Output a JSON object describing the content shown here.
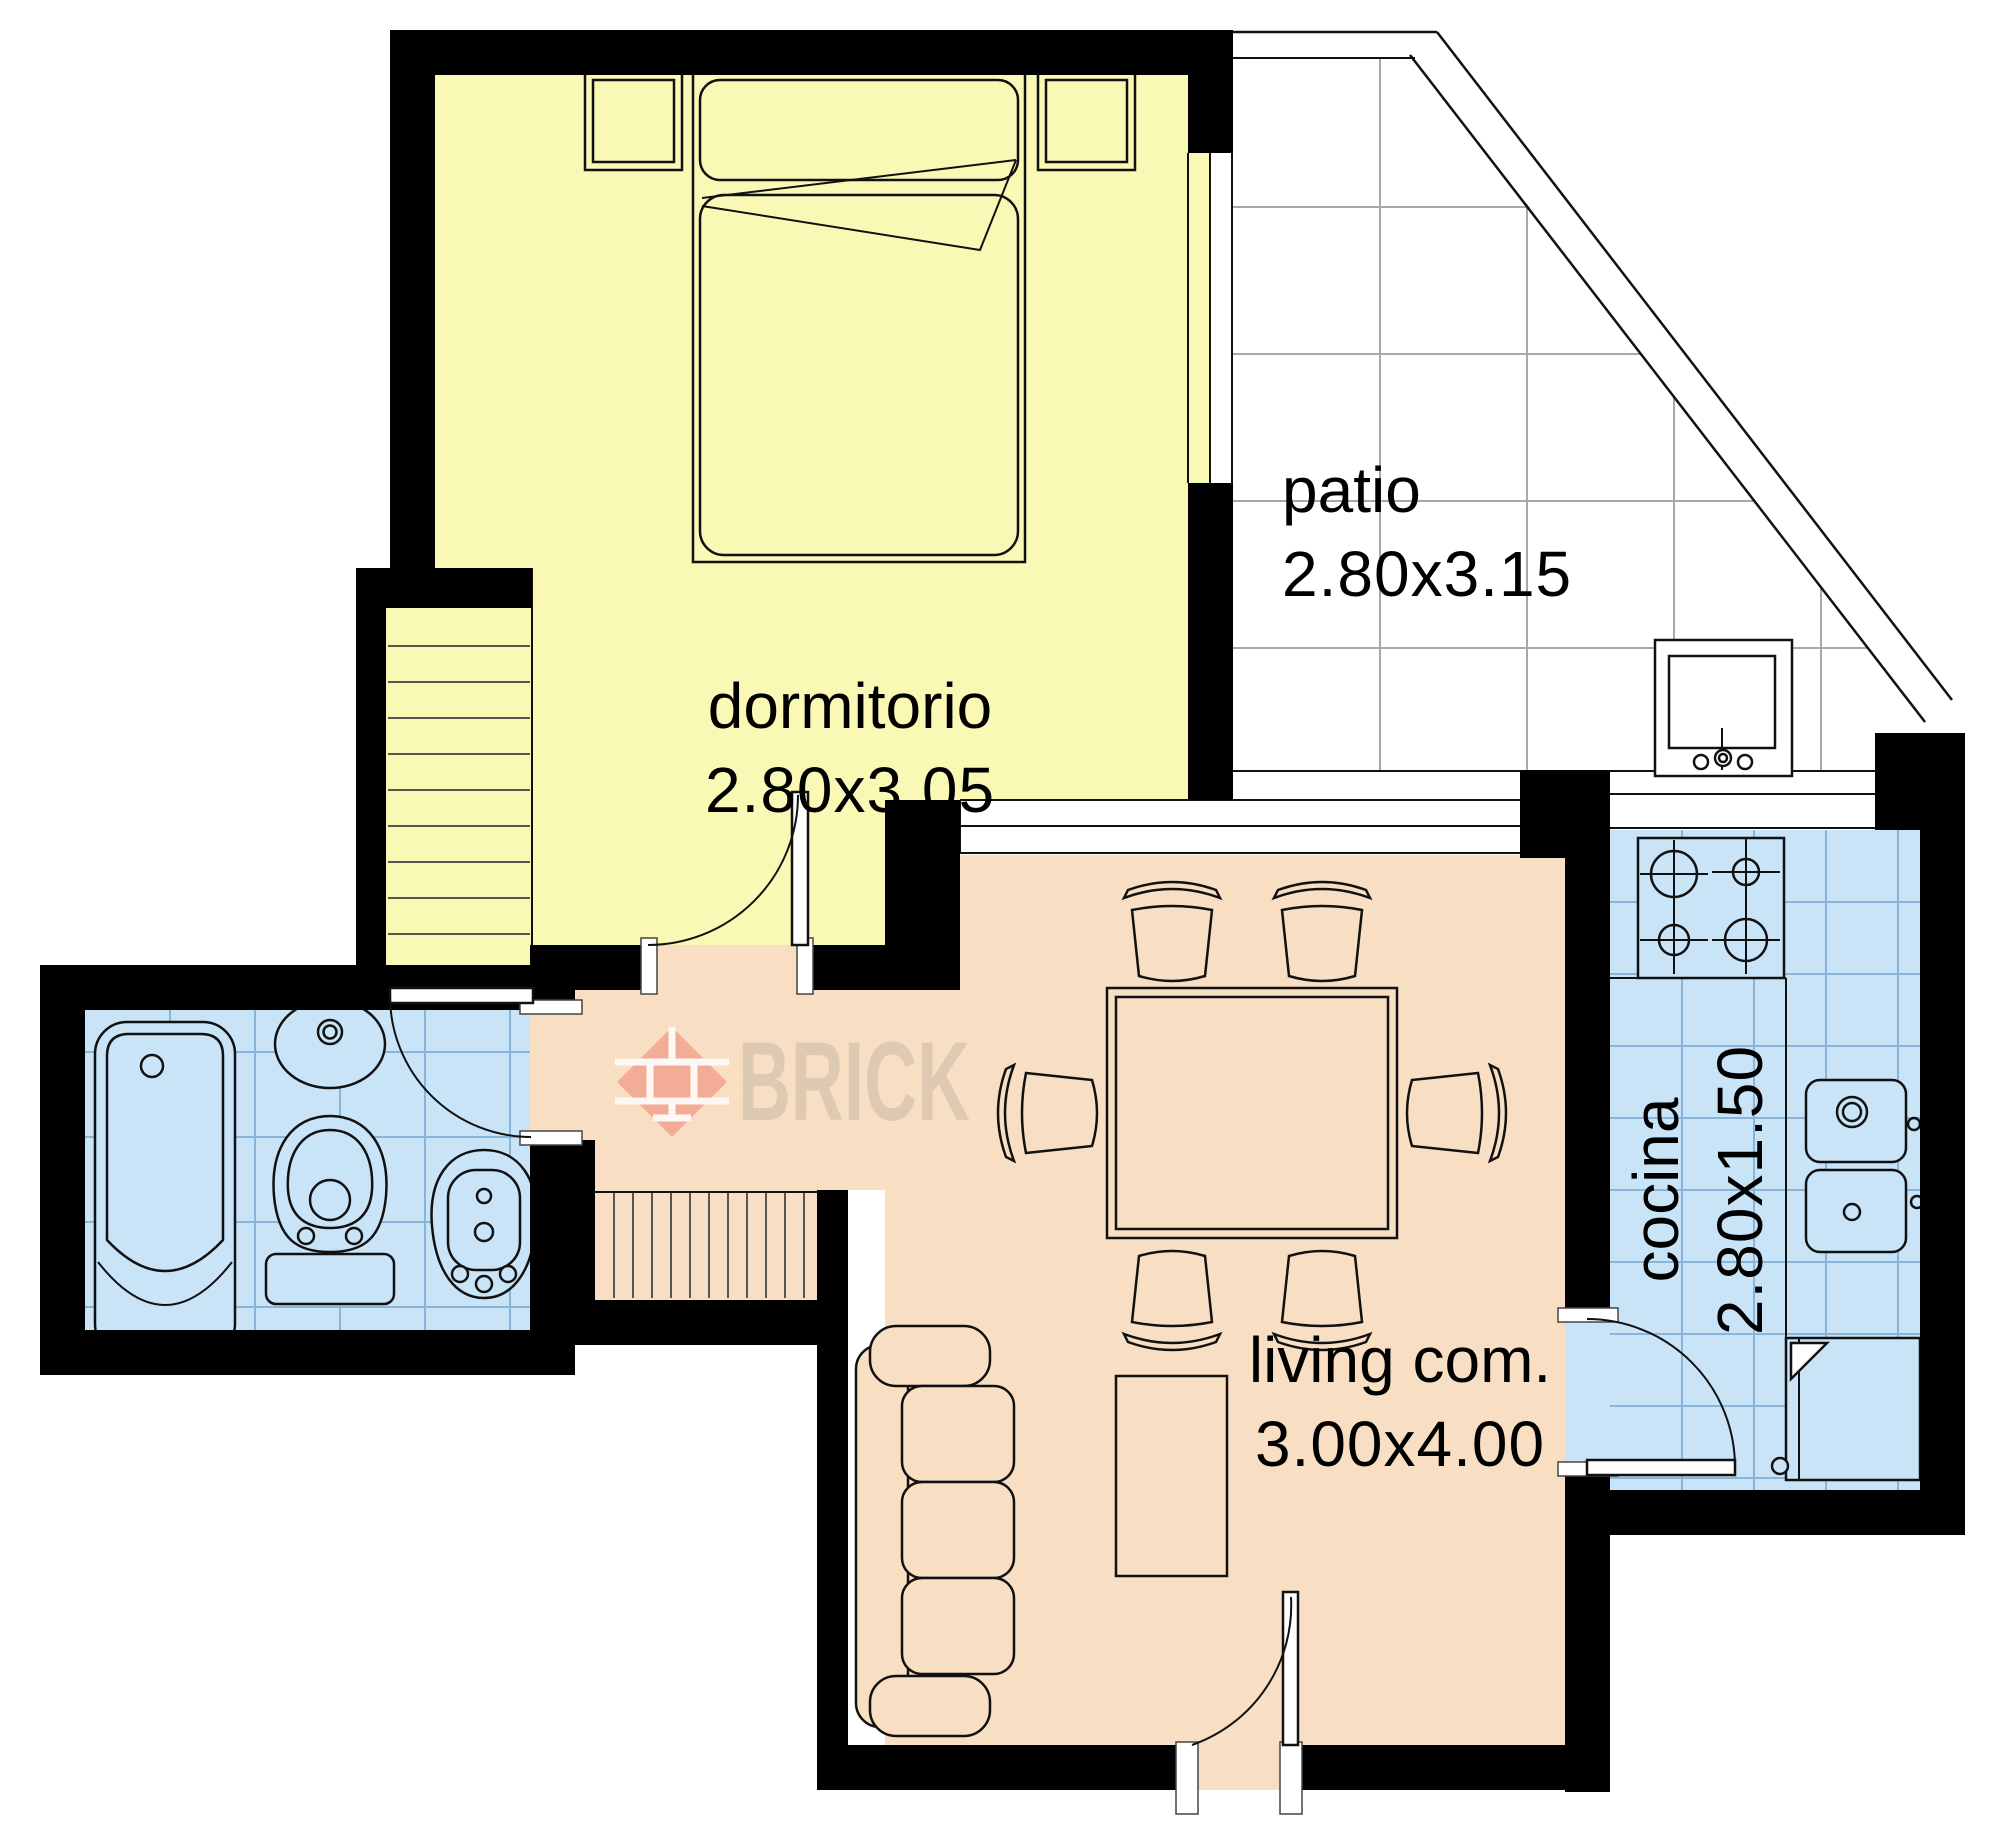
{
  "document": {
    "type": "apartment-floor-plan"
  },
  "watermark": {
    "brand": "BRICK"
  },
  "rooms": {
    "dormitorio": {
      "name": "dormitorio",
      "dims": "2.80x3.05",
      "floor_color": "#f9f9b5"
    },
    "patio": {
      "name": "patio",
      "dims": "2.80x3.15",
      "floor_color": "#ffffff"
    },
    "living": {
      "name": "living com.",
      "dims": "3.00x4.00",
      "floor_color": "#f8dfc3"
    },
    "cocina": {
      "name": "cocina",
      "dims": "2.80x1.50",
      "floor_color": "#c9e4f7"
    },
    "bathroom": {
      "name": "",
      "dims": "",
      "floor_color": "#c9e4f7"
    }
  },
  "fixtures": [
    "double-bed",
    "nightstand-left",
    "nightstand-right",
    "stairs-up",
    "stairs-down",
    "bathtub",
    "washbasin",
    "toilet",
    "bidet",
    "laundry-sink",
    "stove",
    "kitchen-sink",
    "refrigerator",
    "dining-table",
    "six-chairs",
    "sofa",
    "coffee-table"
  ],
  "colors": {
    "wall": "#000000",
    "grid-patio": "#a8a8a8",
    "grid-tile": "#8ab5d8",
    "wm-diamond": "#f2a18c",
    "wm-text": "#d8c5b0"
  }
}
